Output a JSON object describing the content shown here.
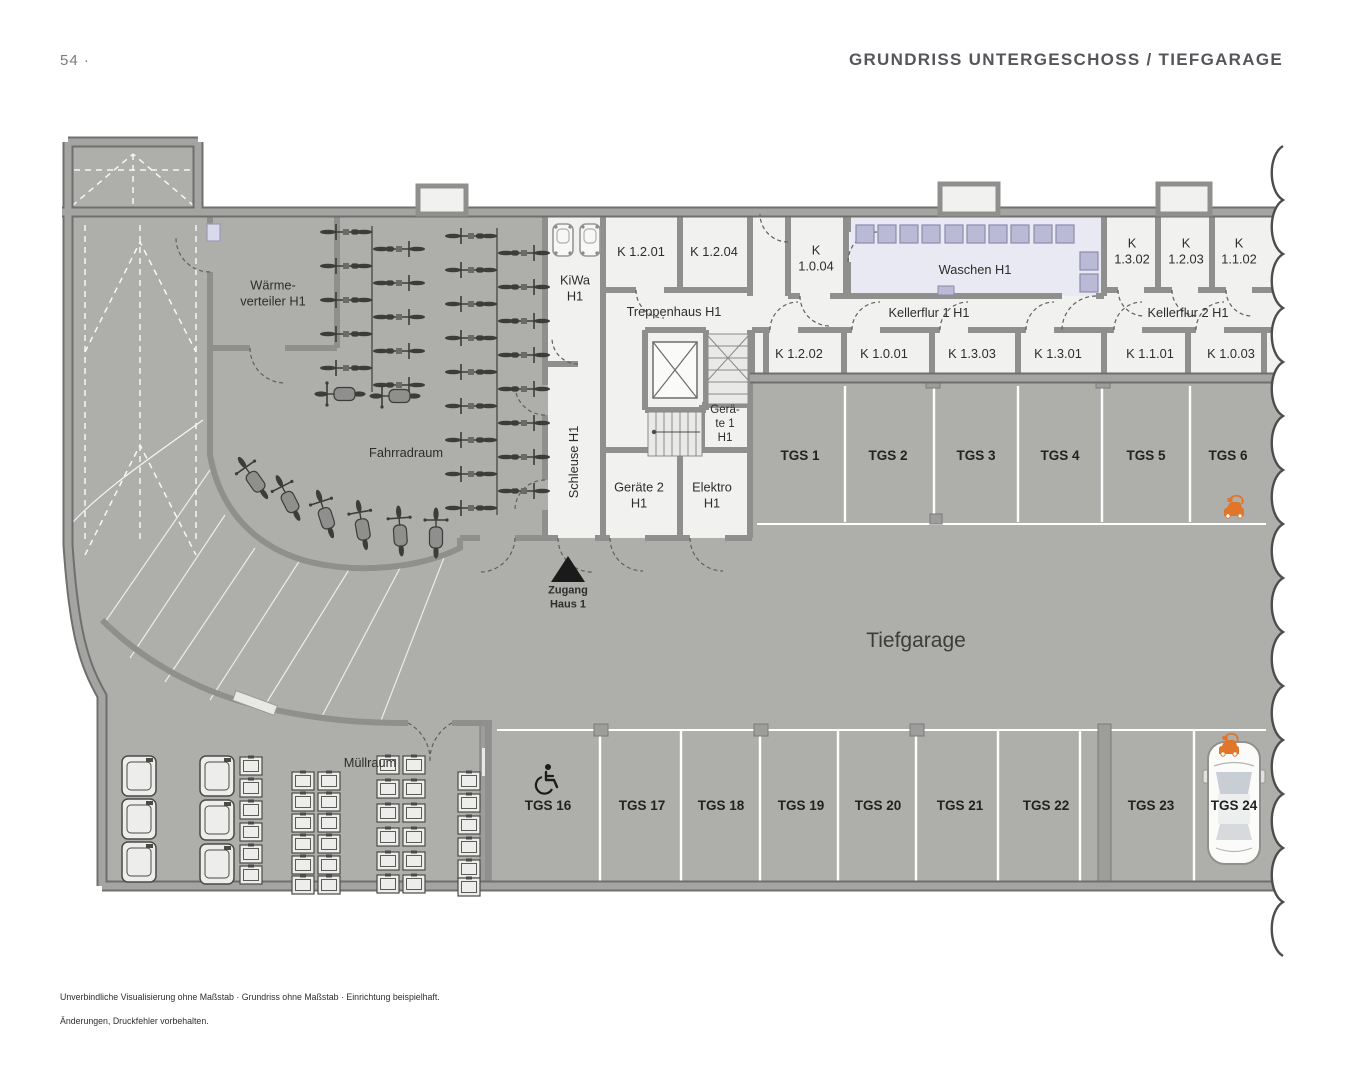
{
  "header": {
    "page_number": "54 ·",
    "title": "GRUNDRISS UNTERGESCHOSS / TIEFGARAGE"
  },
  "rooms": {
    "waermeverteiler": "Wärme-\nverteiler H1",
    "fahrradraum": "Fahrradraum",
    "kiwa": "KiWa\nH1",
    "k_1_2_01": "K 1.2.01",
    "k_1_2_04": "K 1.2.04",
    "treppenhaus": "Treppenhaus H1",
    "k_1_0_04": "K\n1.0.04",
    "waschen": "Waschen H1",
    "k_1_3_02": "K\n1.3.02",
    "k_1_2_03": "K\n1.2.03",
    "k_1_1_02": "K\n1.1.02",
    "kellerflur_1": "Kellerflur 1 H1",
    "kellerflur_2": "Kellerflur 2 H1",
    "k_1_2_02": "K 1.2.02",
    "k_1_0_01": "K 1.0.01",
    "k_1_3_03": "K 1.3.03",
    "k_1_3_01": "K 1.3.01",
    "k_1_1_01": "K 1.1.01",
    "k_1_0_03": "K 1.0.03",
    "geraete_1": "Gerä-\nte 1\nH1",
    "schleuse": "Schleuse H1",
    "geraete_2": "Geräte 2\nH1",
    "elektro": "Elektro\nH1",
    "muellraum": "Müllraum",
    "tiefgarage": "Tiefgarage"
  },
  "markers": {
    "zugang_haus_1": "Zugang\nHaus 1"
  },
  "parking": {
    "top_row": [
      "TGS 1",
      "TGS 2",
      "TGS 3",
      "TGS 4",
      "TGS 5",
      "TGS 6"
    ],
    "bottom_row": [
      "TGS 16",
      "TGS 17",
      "TGS 18",
      "TGS 19",
      "TGS 20",
      "TGS 21",
      "TGS 22",
      "TGS 23",
      "TGS 24"
    ]
  },
  "icons": {
    "ev_charging": "ev-charging-icon",
    "wheelchair": "wheelchair-icon",
    "entrance_arrow": "entrance-arrow-icon",
    "car": "car-top-view"
  },
  "colors": {
    "accent_orange": "#e0762a",
    "room_fill": "#f1f1ef",
    "laundry_fill": "#e9e9f3",
    "machine_fill": "#babad6",
    "garage_floor": "#aeaeab",
    "wall": "#8f8f8d",
    "title_text": "#55565a"
  },
  "footer": {
    "line1": "Unverbindliche Visualisierung ohne Maßstab · Grundriss ohne Maßstab · Einrichtung beispielhaft.",
    "line2": "Änderungen, Druckfehler vorbehalten."
  }
}
